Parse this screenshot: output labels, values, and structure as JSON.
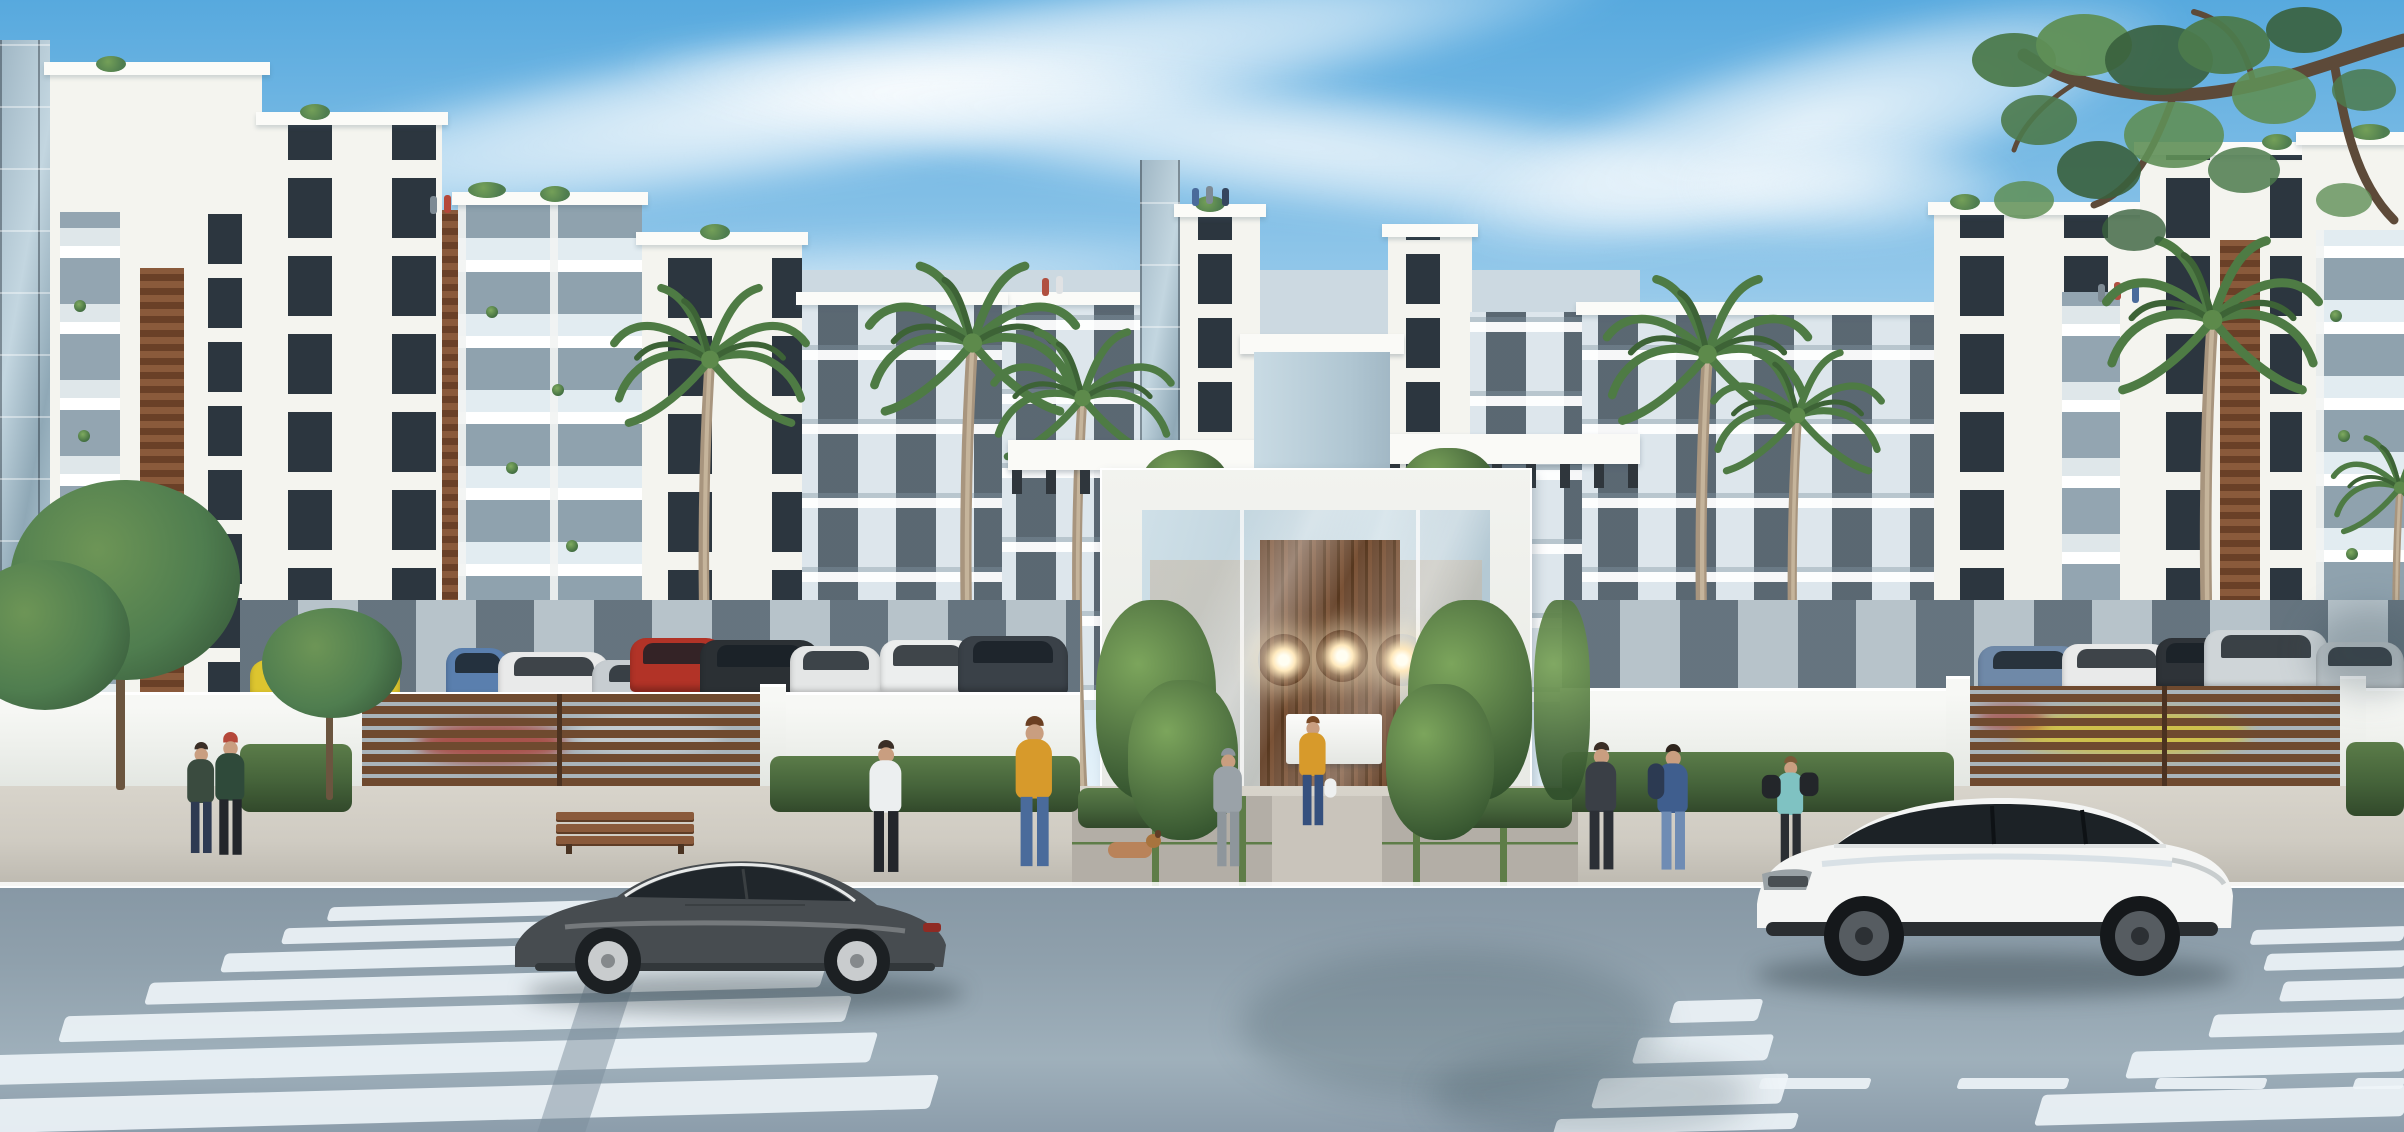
{
  "image_type": "architectural-rendering",
  "palette": {
    "sky_top": "#57a9de",
    "sky_mid": "#a9d3ee",
    "sky_low": "#ebf5fb",
    "building_white": "#f4f4ef",
    "building_shade": "#dde6ec",
    "backdrop_shade": "#ccd9e1",
    "window_dark": "#2c363f",
    "window_shade": "#46525c",
    "glass_tower_a": "#9fb6c4",
    "glass_tower_b": "#c3d6e0",
    "glass_blue": "#b9cdd8",
    "wood_light": "#8a5a3b",
    "wood_dark": "#6a4027",
    "gate_slat": "#6f4a2f",
    "gate_gap": "#a9b4ba",
    "wall_top": "#f7f8f5",
    "wall_bottom": "#dfe3de",
    "hedge_green": "#45633a",
    "bush_green": "#4e7040",
    "palm_green": "#4e7b44",
    "leaf_green": "#4f7d4f",
    "trunk_tan": "#a8957e",
    "branch_brown": "#5d4a39",
    "sidewalk": "#cfcbc2",
    "paver": "#b3aea6",
    "grass_strip": "#5e7d48",
    "road": "#8fa0ac",
    "road_low": "#9fb0bb",
    "stripe_white": "#edf3f7",
    "coupe_gray": "#474c50",
    "glass_dark": "#20262b",
    "suv_white": "#f4f5f4",
    "chandelier_glow": "#ffe9bd",
    "lobby_wood": "#6b4931",
    "interior_warm": "#c8b8a4",
    "skin": "#c99e80",
    "mustard": "#d79a2b",
    "denim": "#4a6b9b",
    "teal": "#7fc2c2",
    "hoodie_gray": "#9aa2a8",
    "navy_blue": "#3f5e8e",
    "car_yellow": "#ddc52f",
    "car_red": "#b23327",
    "car_blue": "#5a7fae",
    "car_silver": "#c7cdd1",
    "car_white": "#e9eaea",
    "car_black": "#2b3034"
  },
  "scene": {
    "setting": "modern white residential complex street view, daytime",
    "sky": {
      "condition": "blue with wispy white cloud streaks"
    },
    "buildings": {
      "left_wing": [
        "glass-curtain-tower",
        "white-block-with-balcony-recess",
        "white-block-wood-accent",
        "glass-balcony-block",
        "stepped-white-block",
        "shaded-balcony-block"
      ],
      "center": [
        "entrance-pergola-left",
        "entrance-column",
        "entrance-pergola-right",
        "back-towers"
      ],
      "right_wing": [
        "shaded-balcony-block",
        "white-block-with-balcony",
        "white-block-wood-accent",
        "corner-glass-block"
      ],
      "details": [
        "rooftop-plants",
        "balcony-plants",
        "rooftop-people"
      ]
    },
    "entrance": {
      "type": "double-height glass lobby portal",
      "features": [
        "white portal frame",
        "wood plank feature wall",
        "three sputnik chandeliers",
        "white reception desk",
        "white lounge seat",
        "flanking bushes",
        "paver forecourt with grass strips"
      ]
    },
    "perimeter": {
      "wall": "white plastered wall with coping",
      "gates": [
        "left horizontal-slat wood gate",
        "right horizontal-slat wood gate"
      ],
      "hedges": "trimmed hedges along wall base"
    },
    "vehicles": {
      "foreground": [
        {
          "type": "coupe",
          "color": "dark-gray",
          "position": "left, crossing zebra stripes"
        },
        {
          "type": "suv",
          "color": "white with black roof",
          "position": "right, in front of gate"
        }
      ],
      "parked_behind_wall": [
        "yellow convertible",
        "blue hatchback",
        "white sedan",
        "silver coupe",
        "red suv",
        "black suv",
        "white hatchback",
        "white suv",
        "dark minivan",
        "blue sedan",
        "white sedan",
        "silver suv",
        "silver car"
      ]
    },
    "people": [
      "couple standing by left wall under small tree",
      "woman in white top walking on left sidewalk",
      "woman in mustard jacket and jeans on left sidewalk",
      "man in gray hoodie on entrance forecourt",
      "woman in mustard cardigan with white bag at entrance",
      "dog lying on forecourt",
      "person in dark clothes right of entrance",
      "man in blue sweater on phone",
      "woman in teal top carrying black duffel bags",
      "small groups on rooftop terraces"
    ],
    "vegetation": {
      "palms": 7,
      "street_trees": 2,
      "overhanging_branch": "top-right corner",
      "bushes": "entrance flanks"
    },
    "road": {
      "surface": "blue-gray asphalt",
      "markings": [
        "wide zebra crosswalk left",
        "zebra crosswalk right",
        "dashed lane line bottom-right",
        "white curb line"
      ]
    }
  }
}
